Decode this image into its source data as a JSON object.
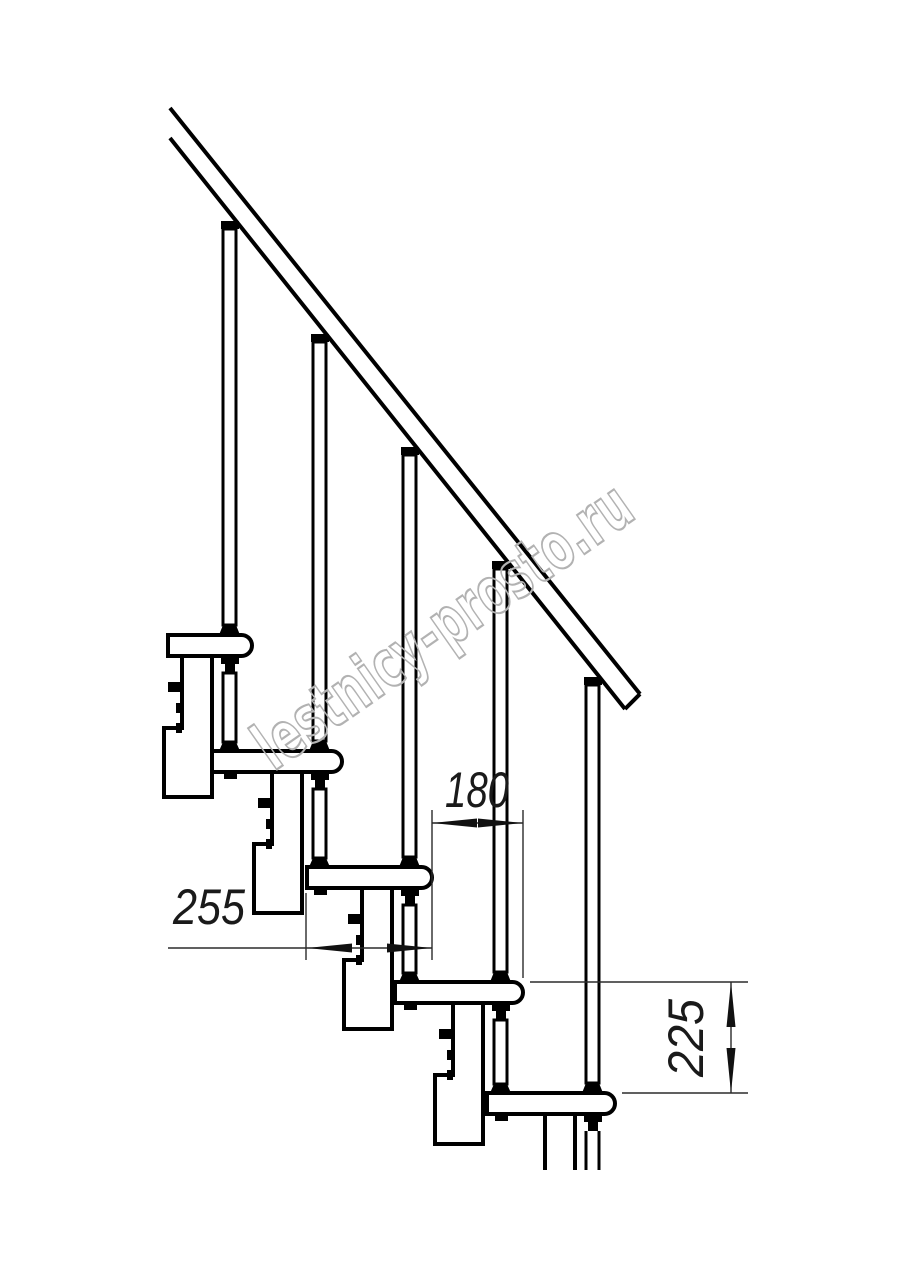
{
  "dimensions": {
    "run": "180",
    "depth": "255",
    "rise": "225"
  },
  "watermark": {
    "text": "lestnicy-prosto.ru",
    "color": "#b2b2b2"
  },
  "colors": {
    "structure_line": "#000000",
    "dimension_line": "#2b2b2b",
    "label_text": "#1a1a1a",
    "background": "#ffffff"
  }
}
